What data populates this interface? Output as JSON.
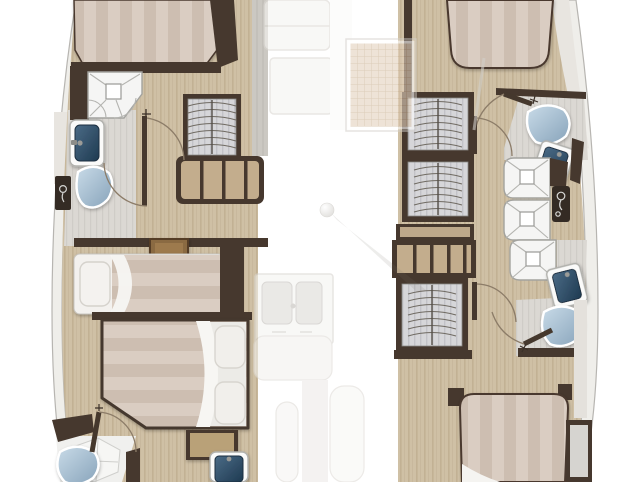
{
  "scene": {
    "kind": "catamaran-lower-deck-floor-plan",
    "orientation": "bow-top, plan cropped at top and bottom edges",
    "counts": {
      "cabins": 4,
      "berths": 5,
      "toilets": 4,
      "washbasins": 4,
      "shower_trays": 5,
      "hanging_lockers": 4
    },
    "port_hull": {
      "forward_cabin": {
        "furniture": [
          "island-double-berth",
          "hanging-locker",
          "shelved-cabinet"
        ],
        "ensuite": [
          "shower-tray",
          "washbasin",
          "toilet",
          "hull-side-panel"
        ]
      },
      "midship": [
        "single-berth-with-pillow",
        "wooden-step-tray"
      ],
      "aft_cabin": {
        "furniture": [
          "island-double-berth-two-pillows",
          "bedside-cabinet"
        ],
        "ensuite": [
          "shower-floor",
          "washbasin",
          "toilet"
        ]
      }
    },
    "starboard_hull": {
      "forward_cabin": {
        "furniture": [
          "island-double-berth",
          "hanging-locker-upper",
          "hanging-locker-lower"
        ],
        "ensuite": [
          "toilet",
          "washbasin",
          "shower-tray"
        ]
      },
      "midship": [
        "shelved-cabinet",
        "hanging-locker"
      ],
      "aft_cabin": {
        "furniture": [
          "island-double-berth",
          "hull-side-cabinet"
        ],
        "ensuite": [
          "shower-tray",
          "shower-tray-2",
          "washbasin",
          "toilet",
          "mixer-panel"
        ]
      }
    },
    "bridgedeck_ghost": [
      "galley-counter-forward",
      "galley-counter",
      "deck-hatch-grid",
      "mast-step-ball",
      "galley-double-sink",
      "saloon-seat",
      "companionway-step",
      "cockpit-bench"
    ]
  },
  "palette": {
    "wall": "#46382e",
    "wall_dark": "#342b24",
    "wood_floor": "#cfc0a5",
    "wood_floor_stripe": "#c2b194",
    "wood_cabinet": "#c3ad8d",
    "tile_floor": "#dbd8d3",
    "tile_stripe": "#cfccc7",
    "mattress": "#dacdc2",
    "mattress_stripe": "#cdbeb1",
    "sheet_white": "#f3f1ee",
    "toilet_blue_light": "#c9dbe8",
    "toilet_blue_dark": "#87a3ba",
    "basin_navy_light": "#4b6b86",
    "basin_navy_dark": "#1e3a51",
    "wardrobe_gray": "#d6d6d9",
    "wardrobe_stripe": "#c2c2c7",
    "hull_band": "#efeeea",
    "hull_line": "#b7b5b1",
    "deck_gray": "#e8e5e0",
    "tray_wood": "#8a6a42",
    "grid_hatch_base": "#e3d2bd",
    "grid_hatch_line": "#c6ab8d"
  }
}
